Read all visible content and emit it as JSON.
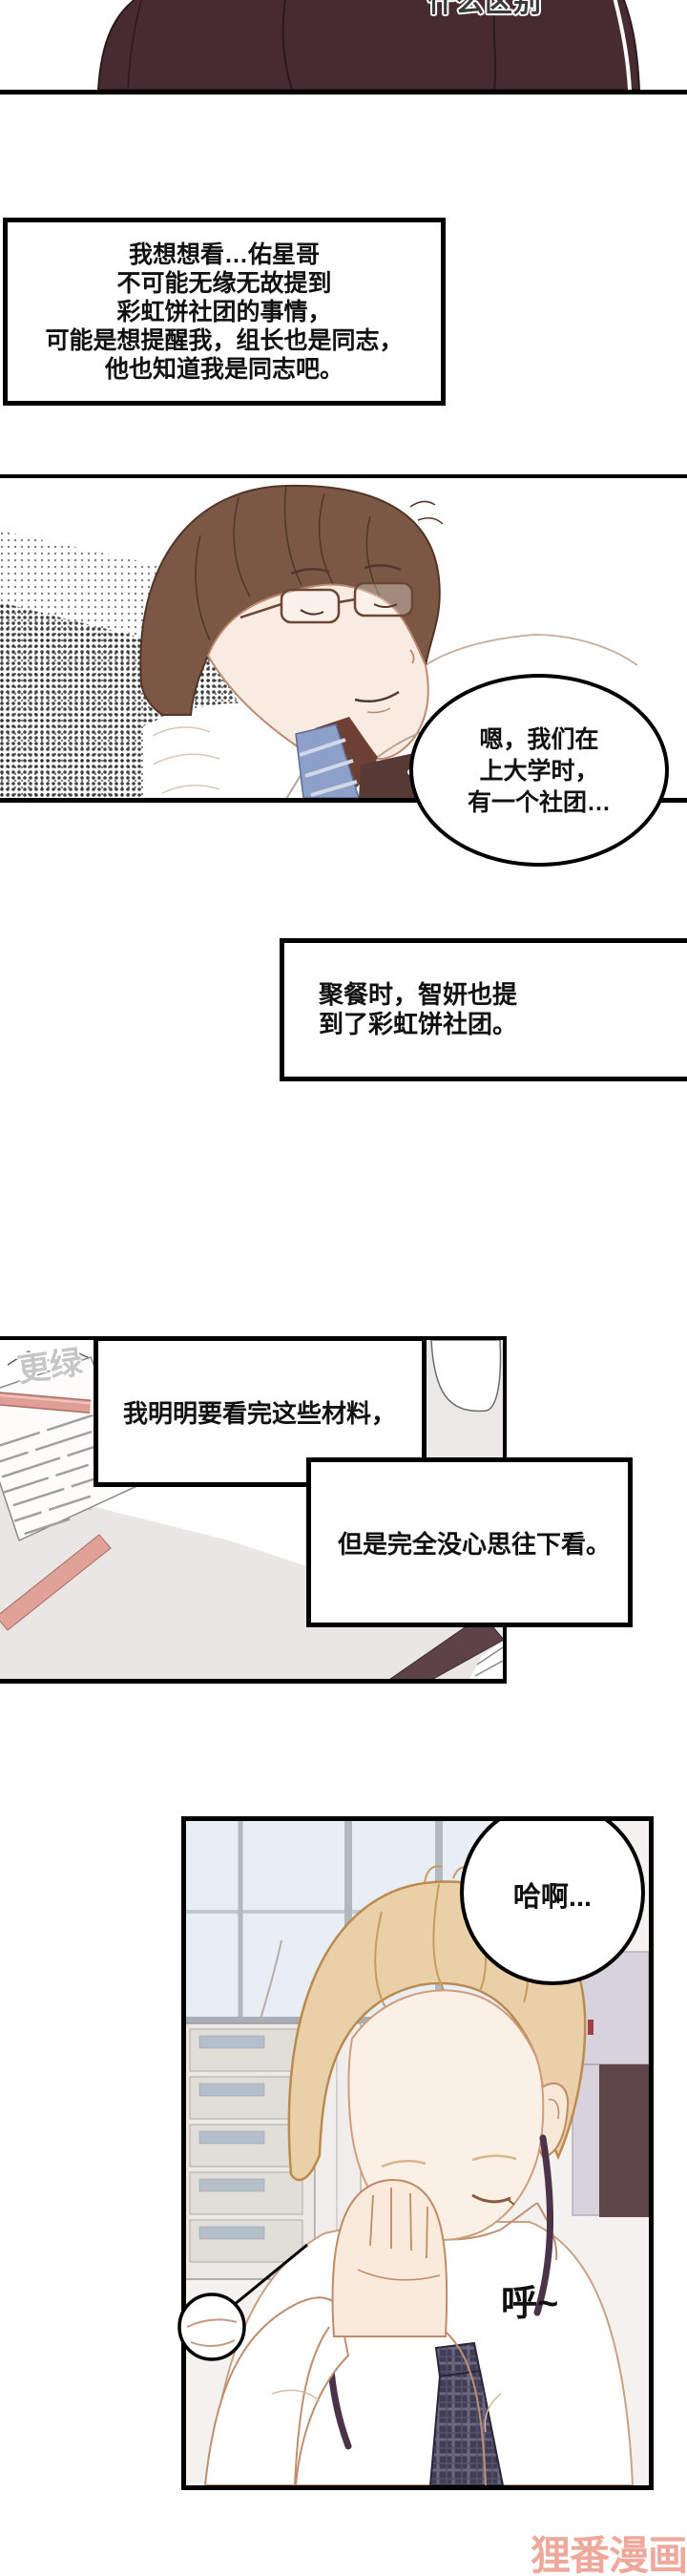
{
  "panel1": {
    "sfx": "什么区别"
  },
  "thought_box": {
    "lines": [
      "我想想看…佑星哥",
      "不可能无缘无故提到",
      "彩虹饼社团的事情，",
      "可能是想提醒我，组长也是同志，",
      "他也知道我是同志吧。"
    ]
  },
  "speech_bubble_1": {
    "lines": [
      "嗯，我们在",
      "上大学时，",
      "有一个社团…"
    ]
  },
  "narration_box_1": {
    "lines": [
      "聚餐时，智妍也提",
      "到了彩虹饼社团。"
    ]
  },
  "panel3": {
    "corner_watermark": "更绿"
  },
  "narration_box_2": {
    "text": "我明明要看完这些材料，"
  },
  "narration_box_3": {
    "text": "但是完全没心思往下看。"
  },
  "speech_bubble_2": {
    "text": "哈啊..."
  },
  "sfx_sigh": "呼~",
  "site_watermark": "狸番漫画",
  "colors": {
    "jacket_maroon": "#462b30",
    "tie_blue": "#8da0c9",
    "hair_brown": "#7a5845",
    "hair_blond": "#ead0a8",
    "lanyard_purple": "#4b3449",
    "pen_pink": "#df9f96",
    "folder_maroon": "#5d4247",
    "site_watermark_pink": "#efa89c",
    "corner_watermark_gray": "#c6c6c6"
  }
}
